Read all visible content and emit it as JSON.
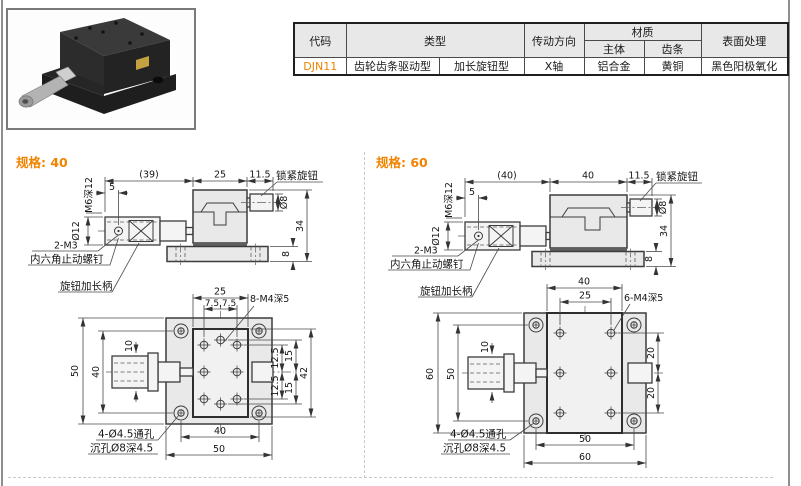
{
  "table": {
    "headers": {
      "code": "代码",
      "type": "类型",
      "drive_direction": "传动方向",
      "material": "材质",
      "material_body": "主体",
      "material_rack": "齿条",
      "surface_treatment": "表面处理"
    },
    "row": {
      "code": "DJN11",
      "type_1": "齿轮齿条驱动型",
      "type_2": "加长旋钮型",
      "drive_direction": "X轴",
      "material_body": "铝合金",
      "material_rack": "黄铜",
      "surface_treatment": "黑色阳极氧化"
    }
  },
  "colors": {
    "accent_orange": "#f08300",
    "table_header_gray": "#e8e8e8",
    "drawing_fill_gray": "#e9e9e9",
    "line_dark": "#3c3c3c"
  },
  "spec40": {
    "title": "规格: 40",
    "side": {
      "len_total": "(39)",
      "body_w": "25",
      "knob_off": "11.5",
      "lock_knob_label": "锁紧旋钮",
      "thread": "M6深12",
      "screw_off": "5",
      "knob_dia": "Ø12",
      "lock_dia": "Ø8",
      "height": "34",
      "base_h": "8",
      "screw_label": "2-M3",
      "setscrew_label": "内六角止动螺钉",
      "handle_label": "旋钮加长柄"
    },
    "plan": {
      "table_w": "25",
      "hole_span": "7.5,7.5",
      "holes_label": "8-M4深5",
      "shaft_dia": "10",
      "plate_l": "50",
      "hole_span_v": "40",
      "row_off_1": "12.5",
      "row_off_2": "15",
      "row_off_3": "12.5",
      "row_off_4": "15",
      "table_l": "42",
      "hole_span_h": "40",
      "plate_w": "50",
      "thru_label": "4-Ø4.5通孔",
      "cbore_label": "沉孔Ø8深4.5"
    }
  },
  "spec60": {
    "title": "规格: 60",
    "side": {
      "len_total": "(40)",
      "body_w": "40",
      "knob_off": "11.5",
      "lock_knob_label": "锁紧旋钮",
      "thread": "M6深12",
      "screw_off": "5",
      "knob_dia": "Ø12",
      "lock_dia": "Ø8",
      "height": "34",
      "base_h": "8",
      "screw_label": "2-M3",
      "setscrew_label": "内六角止动螺钉",
      "handle_label": "旋钮加长柄"
    },
    "plan": {
      "table_w": "40",
      "hole_span": "25",
      "holes_label": "6-M4深5",
      "shaft_dia": "10",
      "plate_l": "60",
      "hole_span_v": "50",
      "row_off_1": "20",
      "row_off_2": "20",
      "hole_span_h": "50",
      "plate_w": "60",
      "thru_label": "4-Ø4.5通孔",
      "cbore_label": "沉孔Ø8深4.5"
    }
  }
}
